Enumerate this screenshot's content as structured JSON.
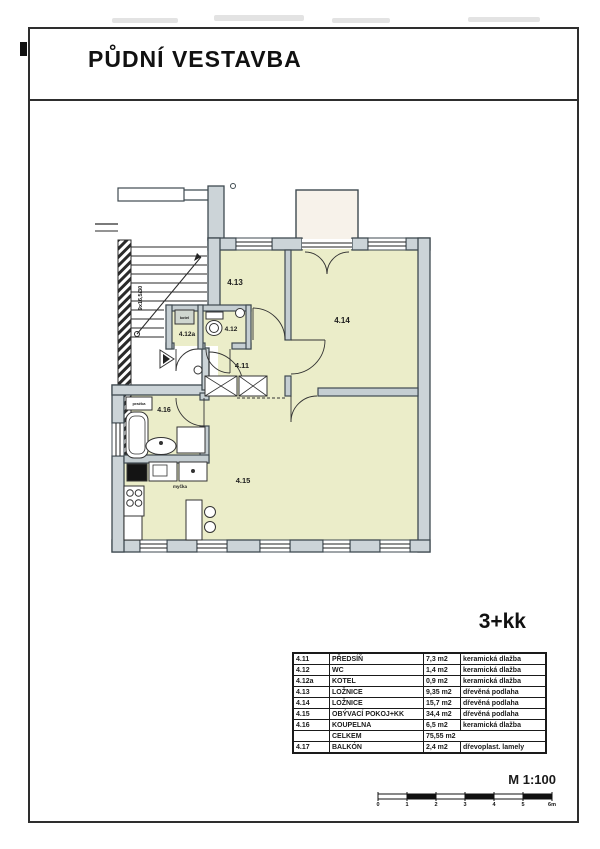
{
  "page": {
    "title": "PŮDNÍ VESTAVBA",
    "unit_type": "3+kk",
    "scale_label": "M 1:100"
  },
  "plan": {
    "rooms": {
      "r411": "4.11",
      "r412": "4.12",
      "r412a": "4.12a",
      "r413": "4.13",
      "r414": "4.14",
      "r415": "4.15",
      "r416": "4.16"
    },
    "stair_note": "9x16,5/30",
    "fixtures": {
      "boiler": "kotel",
      "washer": "pračka",
      "dishwasher": "myčka"
    }
  },
  "legend_table": {
    "rows": [
      {
        "no": "4.11",
        "name": "PŘEDSÍŇ",
        "area": "7,3 m2",
        "floor": "keramická dlažba"
      },
      {
        "no": "4.12",
        "name": "WC",
        "area": "1,4 m2",
        "floor": "keramická dlažba"
      },
      {
        "no": "4.12a",
        "name": "KOTEL",
        "area": "0,9 m2",
        "floor": "keramická dlažba"
      },
      {
        "no": "4.13",
        "name": "LOŽNICE",
        "area": "9,35 m2",
        "floor": "dřevěná podlaha"
      },
      {
        "no": "4.14",
        "name": "LOŽNICE",
        "area": "15,7 m2",
        "floor": "dřevěná podlaha"
      },
      {
        "no": "4.15",
        "name": "OBÝVACÍ POKOJ+KK",
        "area": "34,4 m2",
        "floor": "dřevěná podlaha"
      },
      {
        "no": "4.16",
        "name": "KOUPELNA",
        "area": "6,5 m2",
        "floor": "keramická dlažba"
      },
      {
        "no": "",
        "name": "CELKEM",
        "area": "75,55 m2",
        "floor": "",
        "merge": true
      },
      {
        "no": "4.17",
        "name": "BALKÓN",
        "area": "2,4 m2",
        "floor": "dřevoplast. lamely"
      }
    ]
  },
  "scale_bar": {
    "ticks": [
      "0",
      "1",
      "2",
      "3",
      "4",
      "5",
      "6m"
    ]
  },
  "colors": {
    "room_fill": "#ebedc9",
    "wall_fill": "#ccd4d8",
    "wall_line": "#3f4a50",
    "balcony_fill": "#f7f2ea",
    "thin_line": "#222222"
  }
}
